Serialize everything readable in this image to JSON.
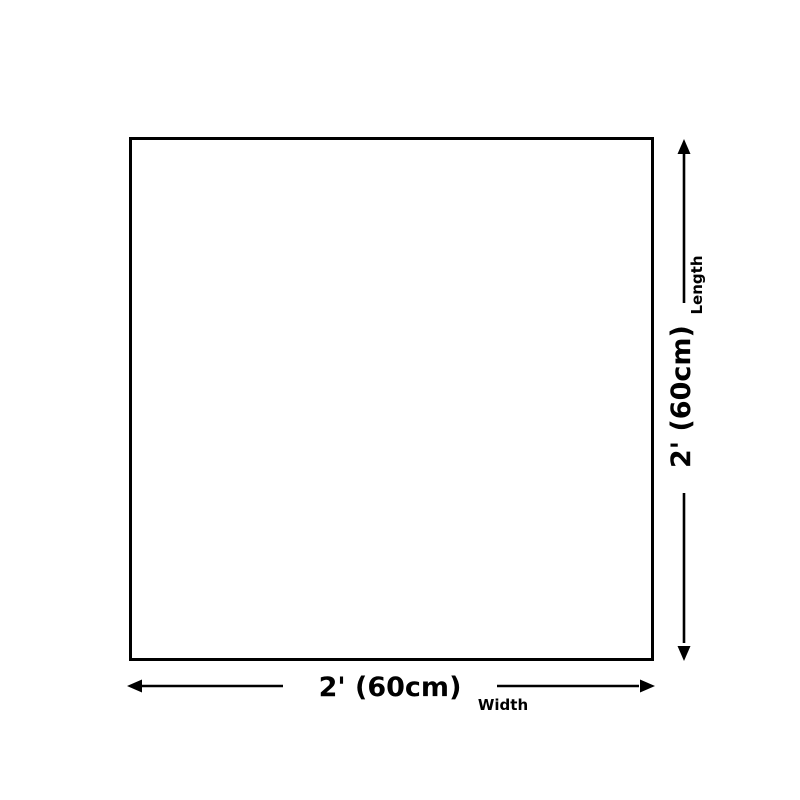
{
  "diagram": {
    "shape": "square",
    "dimensions": {
      "width": {
        "value": "2' (60cm)",
        "label": "Width"
      },
      "length": {
        "value": "2' (60cm)",
        "label": "Length"
      }
    }
  },
  "colors": {
    "background": "#ffffff",
    "line": "#000000",
    "text": "#000000"
  }
}
